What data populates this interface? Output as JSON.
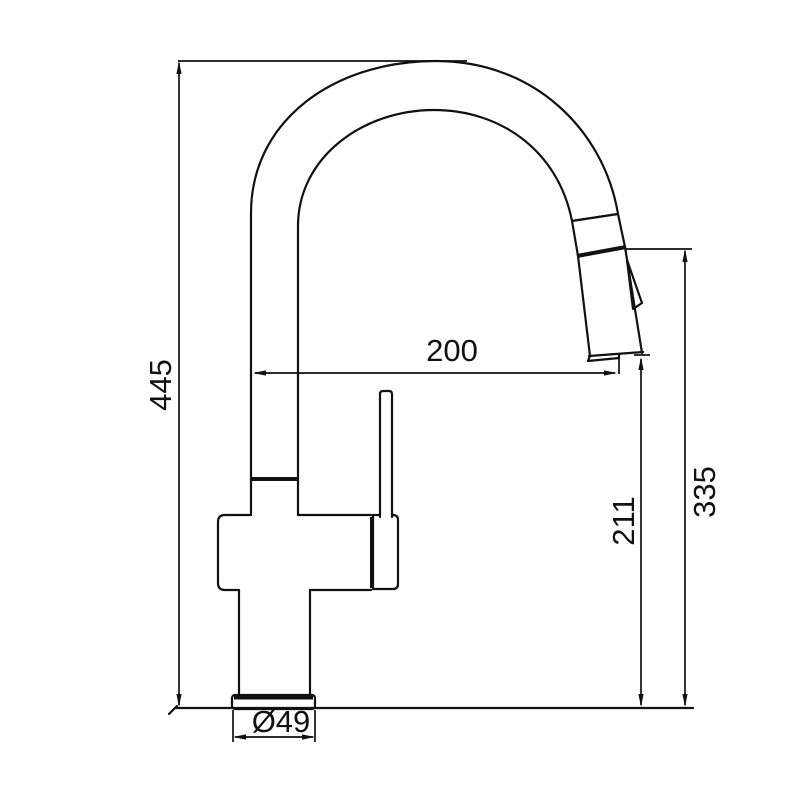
{
  "drawing": {
    "type": "faucet-technical-drawing",
    "background": "#ffffff",
    "line_color": "#111111",
    "labels": {
      "overall_height": "445",
      "spout_reach": "200",
      "outlet_height": "211",
      "spout_top_height": "335",
      "base_diameter": "Ø49"
    }
  }
}
